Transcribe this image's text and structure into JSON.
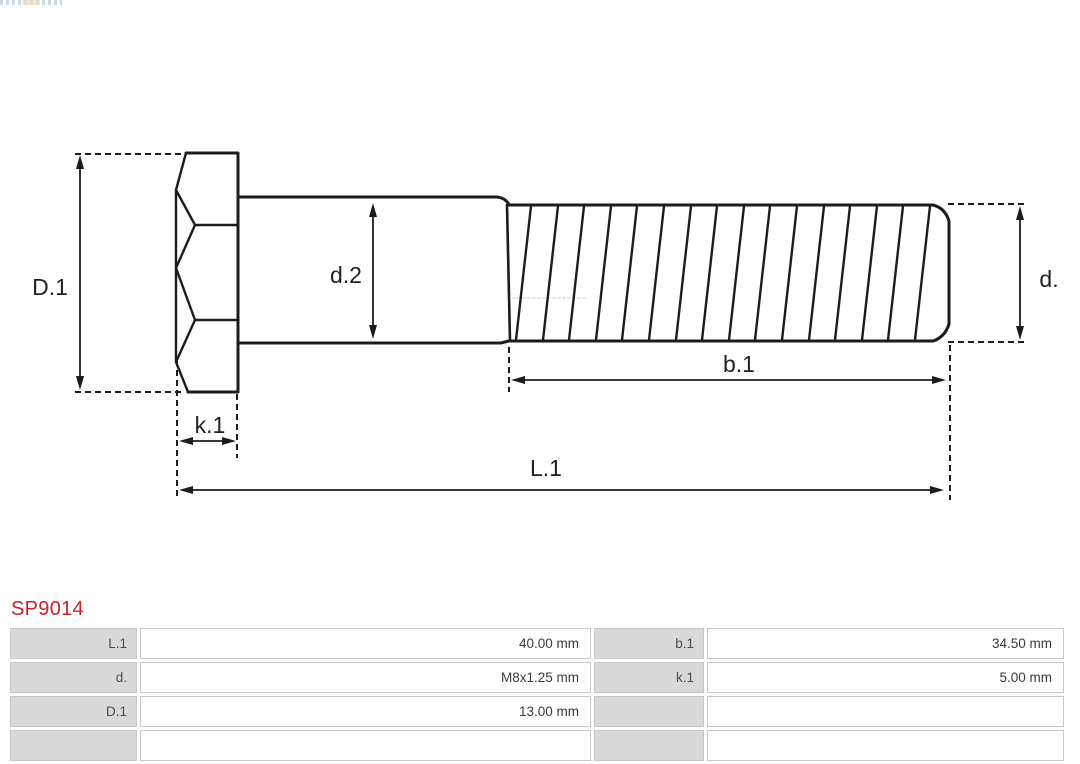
{
  "part": {
    "number": "SP9014"
  },
  "diagram": {
    "type": "technical-drawing",
    "subject": "hex-head bolt side view with dimension callouts",
    "labels": {
      "D1": "D.1",
      "d2": "d.2",
      "d": "d.",
      "k1": "k.1",
      "b1": "b.1",
      "L1": "L.1"
    }
  },
  "spec_table": {
    "rows": [
      {
        "c0": {
          "label": "L.1",
          "value": "40.00 mm"
        },
        "c1": {
          "label": "b.1",
          "value": "34.50 mm"
        }
      },
      {
        "c0": {
          "label": "d.",
          "value": "M8x1.25 mm"
        },
        "c1": {
          "label": "k.1",
          "value": "5.00 mm"
        }
      },
      {
        "c0": {
          "label": "D.1",
          "value": "13.00 mm"
        },
        "c1": {
          "label": "",
          "value": ""
        }
      },
      {
        "c0": {
          "label": "",
          "value": ""
        },
        "c1": {
          "label": "",
          "value": ""
        }
      }
    ]
  },
  "colors": {
    "part_number": "#cb2027",
    "drawing_line": "#1c1c1c",
    "table_label_bg": "#d9d9d9",
    "table_border": "#c9c9c9",
    "table_label_text": "#4d4d4d",
    "table_value_text": "#3a3a3a"
  }
}
